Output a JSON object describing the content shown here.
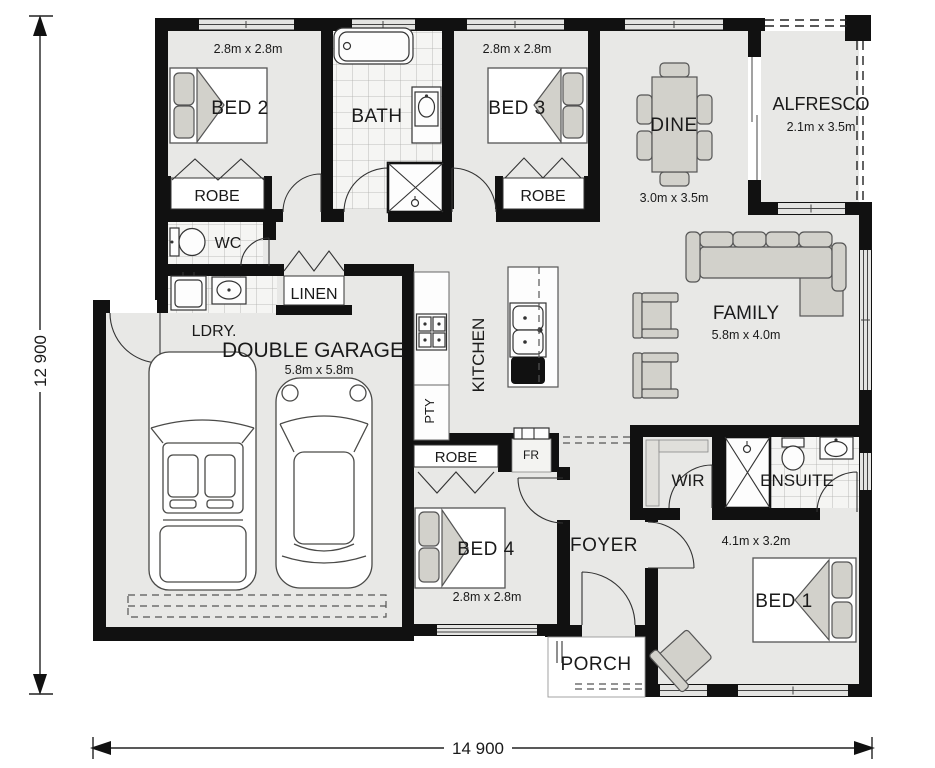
{
  "plan": {
    "overall_dimensions": {
      "width_label": "14 900",
      "depth_label": "12 900"
    },
    "rooms": {
      "bed2": {
        "name": "BED 2",
        "size": "2.8m x 2.8m"
      },
      "bath": {
        "name": "BATH"
      },
      "bed3": {
        "name": "BED 3",
        "size": "2.8m x 2.8m"
      },
      "dine": {
        "name": "DINE",
        "size": "3.0m x 3.5m"
      },
      "alfresco": {
        "name": "ALFRESCO",
        "size": "2.1m x 3.5m"
      },
      "robe2": {
        "name": "ROBE"
      },
      "robe3": {
        "name": "ROBE"
      },
      "wc": {
        "name": "WC"
      },
      "ldry": {
        "name": "LDRY."
      },
      "linen": {
        "name": "LINEN"
      },
      "kitchen": {
        "name": "KITCHEN"
      },
      "pty": {
        "name": "PTY"
      },
      "family": {
        "name": "FAMILY",
        "size": "5.8m x 4.0m"
      },
      "garage": {
        "name": "DOUBLE GARAGE",
        "size": "5.8m x 5.8m"
      },
      "robe4": {
        "name": "ROBE"
      },
      "fr": {
        "name": "FR"
      },
      "bed4": {
        "name": "BED 4",
        "size": "2.8m x 2.8m"
      },
      "foyer": {
        "name": "FOYER"
      },
      "wir": {
        "name": "WIR"
      },
      "ensuite": {
        "name": "ENSUITE"
      },
      "bed1": {
        "name": "BED 1",
        "size": "4.1m x 3.2m"
      },
      "porch": {
        "name": "PORCH"
      }
    },
    "colors": {
      "wall": "#111111",
      "floor": "#e8e8e6",
      "tile_floor": "#f5f5f3",
      "tile_line": "#adadaa",
      "furniture": "#d2d1cb",
      "outline": "#555555",
      "background": "#ffffff"
    }
  }
}
